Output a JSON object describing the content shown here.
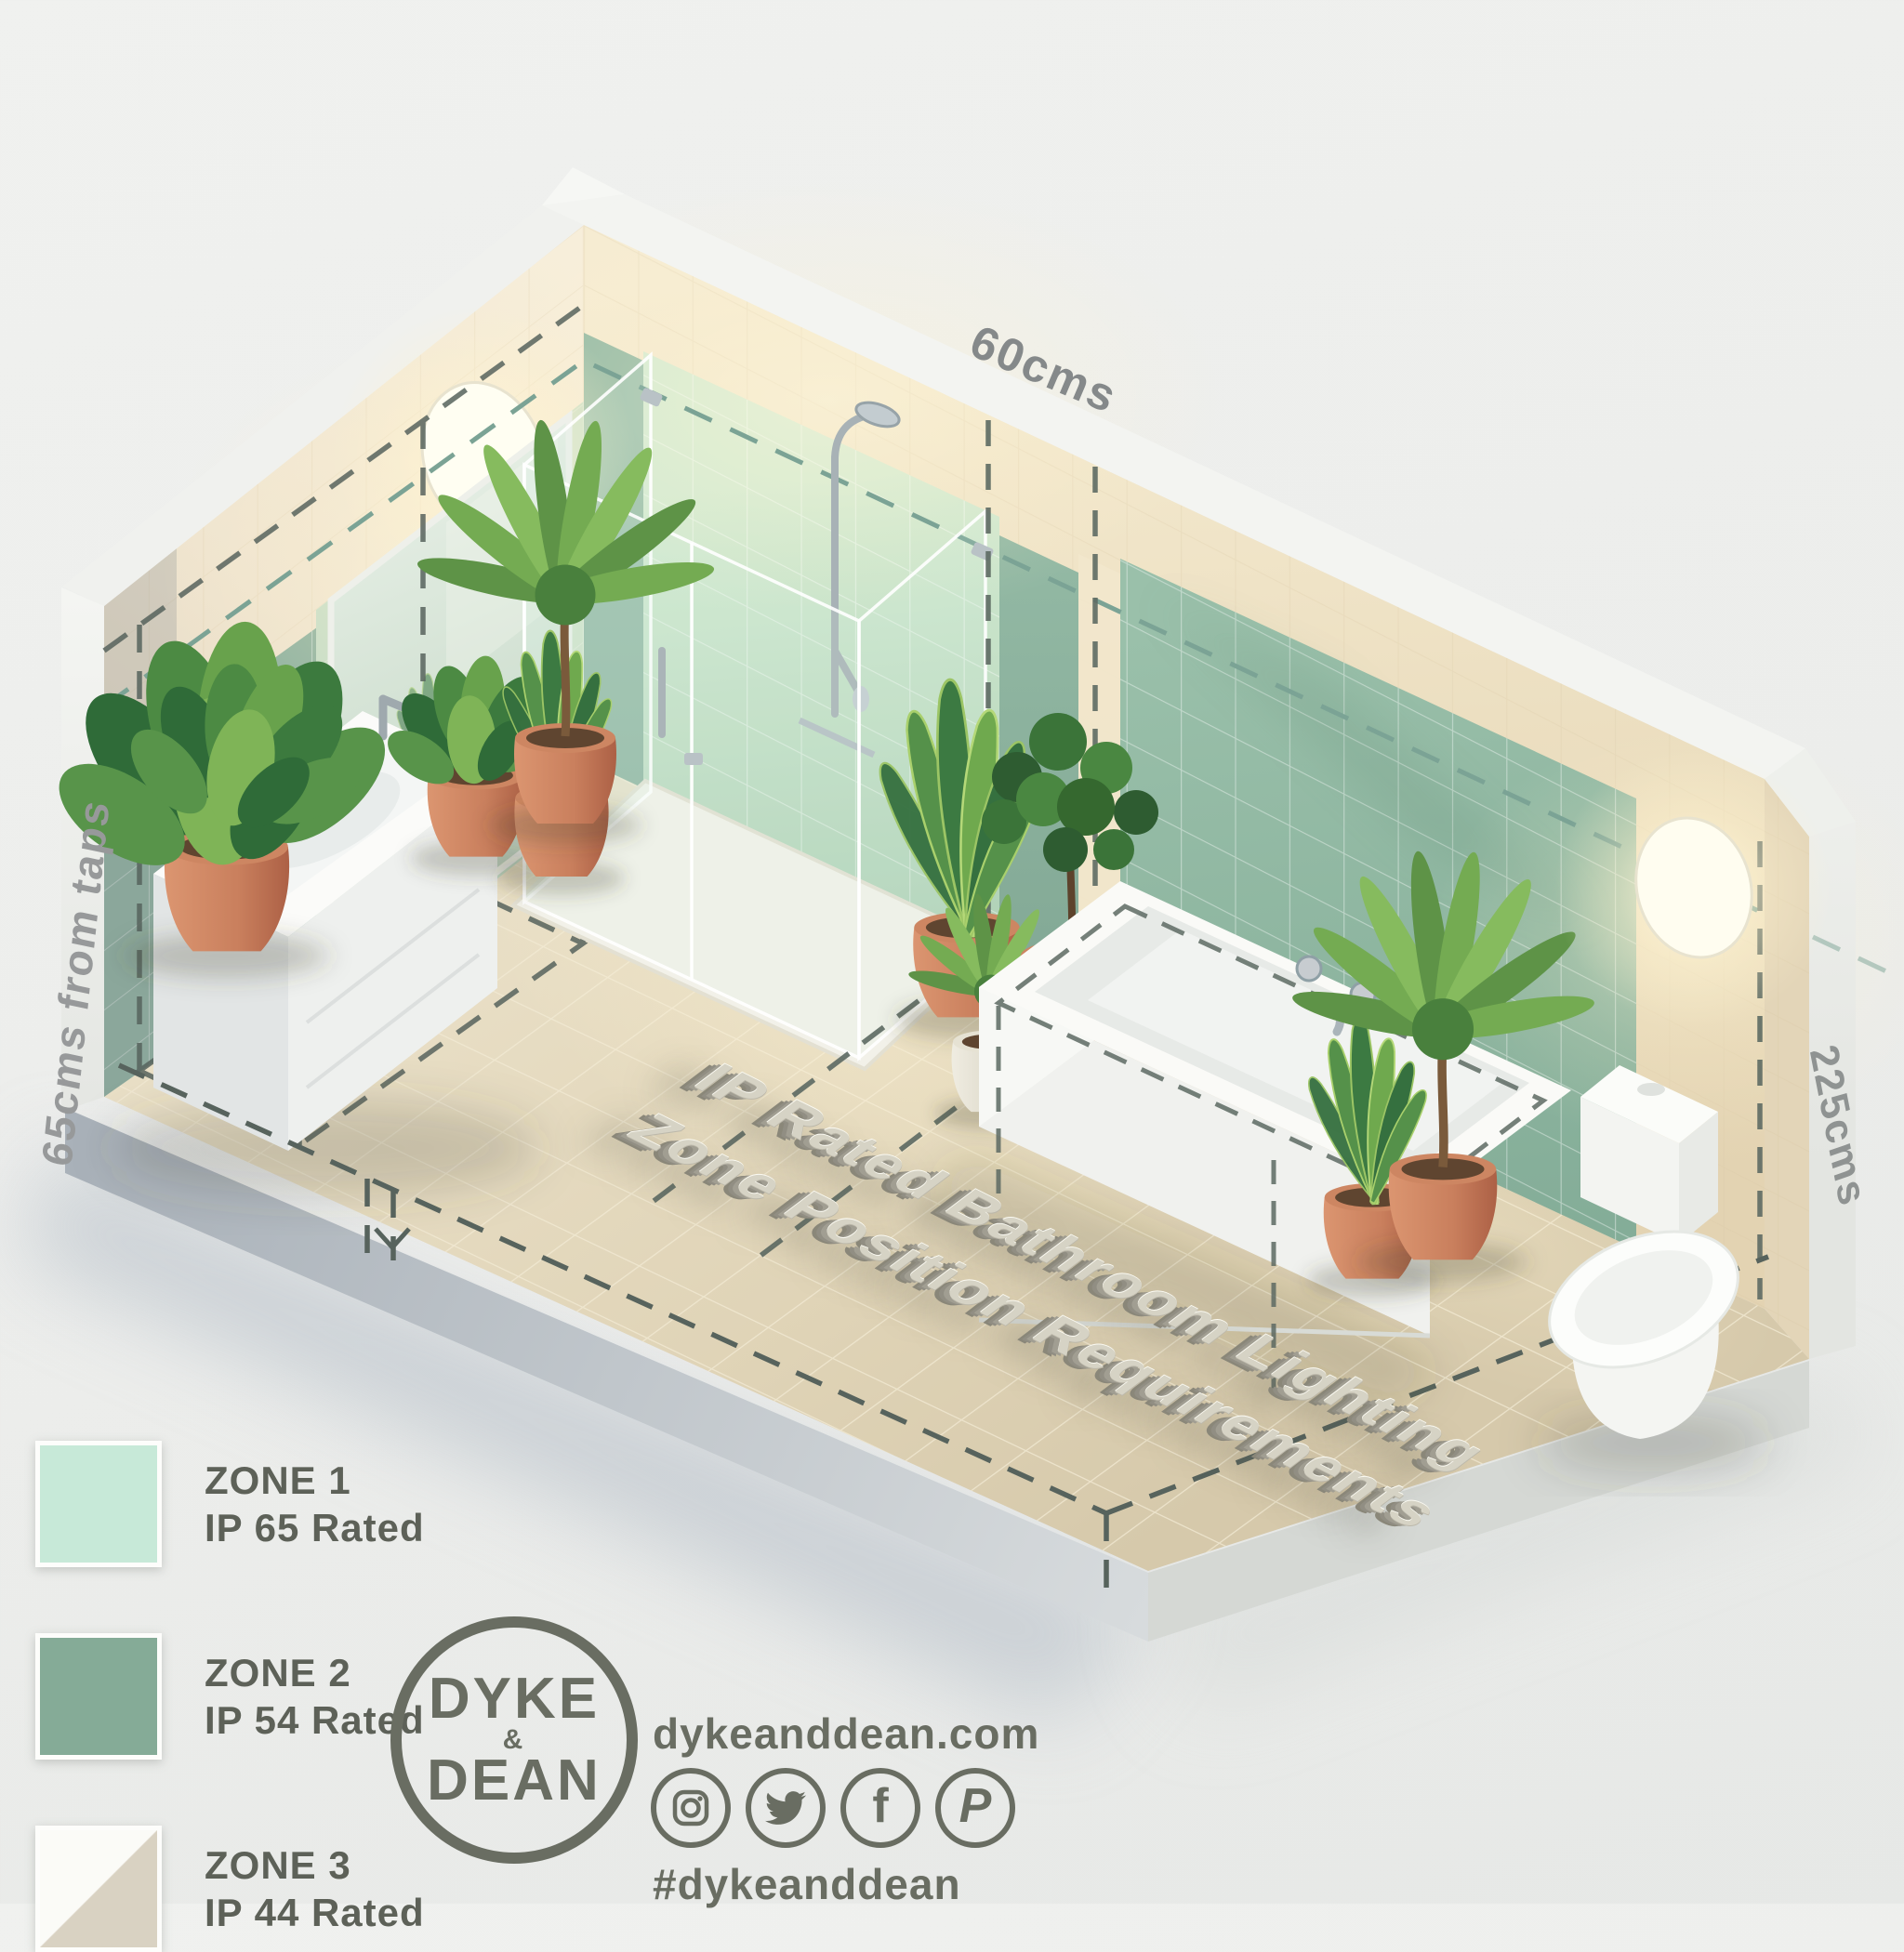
{
  "scene": {
    "title_line1": "IP Rated Bathroom Lighting",
    "title_line2": "Zone Position Requirements",
    "dim_top": "60cms",
    "dim_left": "65cms from taps",
    "dim_right": "225cms",
    "fixtures": [
      "ceiling-light-left",
      "mirror",
      "vanity-sink",
      "shower-enclosure",
      "bathtub",
      "toilet",
      "wall-light-right",
      "potted-plants"
    ],
    "zone_colors": {
      "zone1_mint": "#c7e9d8",
      "zone2_green": "#85ab97",
      "zone3_white": "#fbfbf7",
      "zone3_beige": "#d9d2c2"
    },
    "accent_colors": {
      "terracotta": "#c9805f",
      "floor_tile": "#e2d7bc",
      "wall_cream": "#f0e6d2",
      "dash_dark": "#57635d",
      "dash_teal": "#7ba395"
    }
  },
  "legend": {
    "items": [
      {
        "zone": "ZONE 1",
        "rating": "IP 65 Rated",
        "swatch_style": "background:#c7e9d8"
      },
      {
        "zone": "ZONE 2",
        "rating": "IP 54 Rated",
        "swatch_style": "background:#85ab97"
      },
      {
        "zone": "ZONE 3",
        "rating": "IP 44 Rated",
        "swatch_style": "background:linear-gradient(135deg,#fbfbf7 49.6%,#d9d2c2 50.4%)"
      }
    ]
  },
  "footer": {
    "logo_line1": "DYKE",
    "logo_amp": "&",
    "logo_line2": "DEAN",
    "website": "dykeanddean.com",
    "hashtag": "#dykeanddean",
    "social_icons": [
      "instagram",
      "twitter",
      "facebook",
      "pinterest"
    ]
  }
}
